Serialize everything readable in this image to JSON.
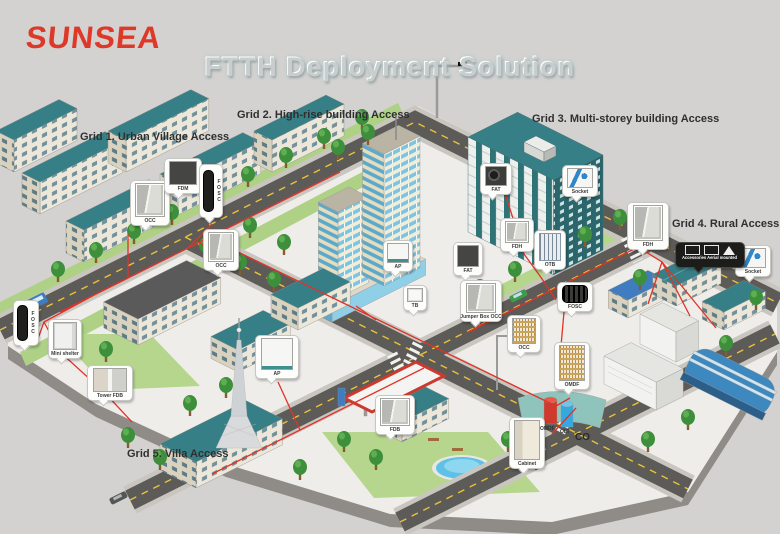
{
  "brand": {
    "logo_text": "SUNSEA",
    "logo_color": "#dd3828"
  },
  "title": {
    "text": "FTTH Deployment Solution"
  },
  "grid_labels": [
    {
      "id": "grid-1",
      "label": "Grid 1. Urban Village Access"
    },
    {
      "id": "grid-2",
      "label": "Grid 2. High-rise building Access"
    },
    {
      "id": "grid-3",
      "label": "Grid 3. Multi-storey building Access"
    },
    {
      "id": "grid-4",
      "label": "Grid 4. Rural Access"
    },
    {
      "id": "grid-5",
      "label": "Grid 5. Villa Access"
    }
  ],
  "callouts": [
    {
      "id": "occ-urban-village",
      "label": "OCC",
      "device": "street-cabinet"
    },
    {
      "id": "fdm-urban-village",
      "label": "FDM",
      "device": "fiber-distribution-module"
    },
    {
      "id": "fosc-urban-village",
      "label": "FOSC",
      "device": "splice-closure-vertical"
    },
    {
      "id": "occ-crossroad",
      "label": "OCC",
      "device": "street-cabinet"
    },
    {
      "id": "ap-high-rise",
      "label": "AP",
      "device": "access-point-box"
    },
    {
      "id": "fat-high-rise",
      "label": "FAT",
      "device": "fiber-access-terminal"
    },
    {
      "id": "tb-high-rise",
      "label": "TB",
      "device": "terminal-box"
    },
    {
      "id": "jumper-box-occ",
      "label": "Jumper Box OCC",
      "device": "street-cabinet"
    },
    {
      "id": "fat-multi-storey",
      "label": "FAT",
      "device": "fiber-access-terminal"
    },
    {
      "id": "socket-multi-storey",
      "label": "Socket",
      "device": "optical-socket"
    },
    {
      "id": "fdh-multi-storey",
      "label": "FDH",
      "device": "fiber-distribution-hub"
    },
    {
      "id": "otb-multi-storey",
      "label": "OTB",
      "device": "optical-terminal-box"
    },
    {
      "id": "fosc-central",
      "label": "FOSC",
      "device": "splice-closure-horizontal"
    },
    {
      "id": "occ-central",
      "label": "OCC",
      "device": "street-cabinet"
    },
    {
      "id": "omdf-co",
      "label": "OMDF",
      "device": "optical-main-distribution-frame"
    },
    {
      "id": "fdh-rural",
      "label": "FDH",
      "device": "fiber-distribution-hub"
    },
    {
      "id": "socket-rural",
      "label": "Socket",
      "device": "optical-socket"
    },
    {
      "id": "mini-shelter",
      "label": "Mini shelter",
      "device": "mini-shelter"
    },
    {
      "id": "fosc-left",
      "label": "FOSC",
      "device": "splice-closure-vertical"
    },
    {
      "id": "tower-fdb",
      "label": "Tower FDB",
      "device": "fiber-distribution-box-wide"
    },
    {
      "id": "ap-villa",
      "label": "AP",
      "device": "access-point-box"
    },
    {
      "id": "fdb-villa",
      "label": "FDB",
      "device": "fiber-distribution-box"
    },
    {
      "id": "cabinet-co",
      "label": "Cabinet",
      "device": "outdoor-cabinet"
    },
    {
      "id": "accessories-aerial",
      "label": "Accessories Aerial mounted",
      "device": "aerial-accessories-strip"
    }
  ],
  "co_area": {
    "omdf_label": "OMDF",
    "olt_label": "OLT",
    "co_label": "CO"
  },
  "colors": {
    "fiber_line": "#e03328",
    "roof_teal": "#377f86",
    "wall_cream": "#ece7d9",
    "road": "#5d5b58",
    "green": "#b5d68c",
    "logo_red": "#dd3828",
    "title_silver": "#c9cdcd"
  }
}
